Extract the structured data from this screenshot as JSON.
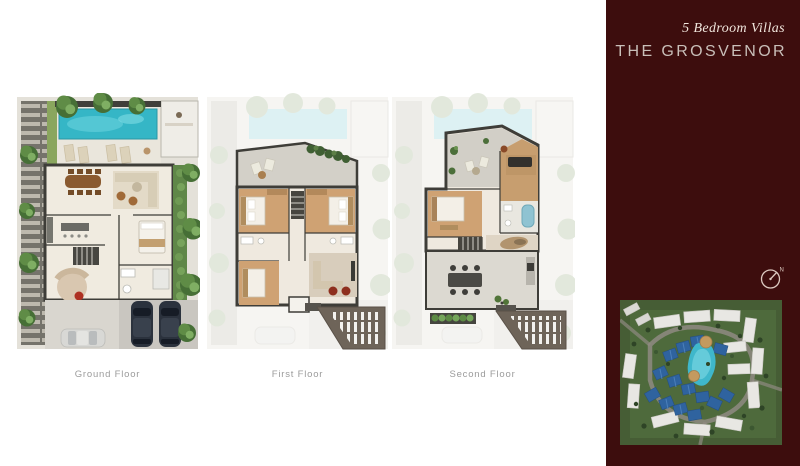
{
  "header": {
    "subtitle": "5 Bedroom Villas",
    "title": "THE GROSVENOR"
  },
  "floors": [
    {
      "label": "Ground Floor"
    },
    {
      "label": "First Floor"
    },
    {
      "label": "Second Floor"
    }
  ],
  "compass": {
    "north_label": "N"
  },
  "colors": {
    "page_bg": "#ffffff",
    "sidebar_bg": "#3d0d0d",
    "subtitle_text": "#f0e5dc",
    "title_text": "#c9bfb9",
    "floor_label_text": "#9b9b9b",
    "pool": "#35b6c6",
    "wall": "#3e3d38",
    "grass": "#8aa65e",
    "bedroom_floor": "#cfa273",
    "roof_hatch": "#6e6459",
    "car_dark": "#2b323d",
    "aerial_blue_roof": "#2f639f"
  }
}
